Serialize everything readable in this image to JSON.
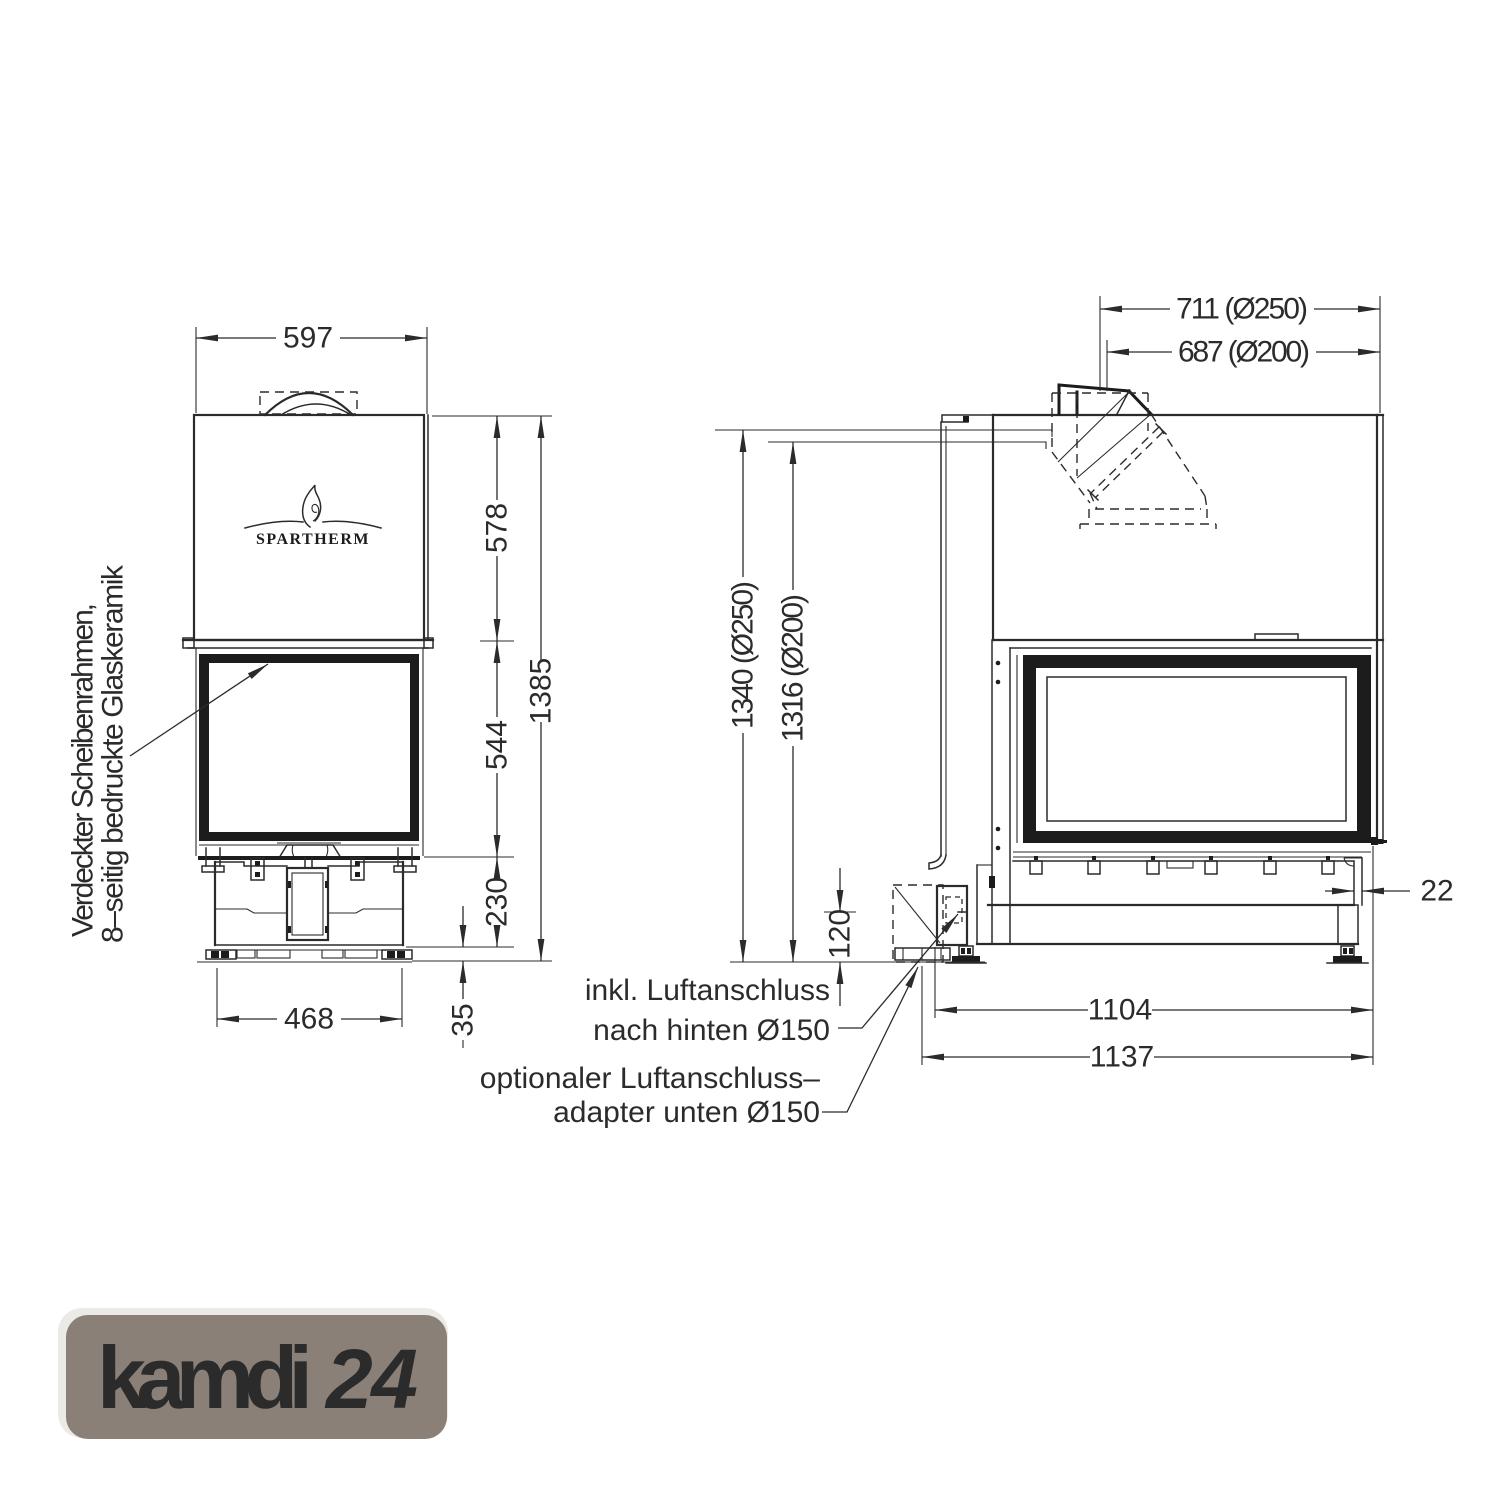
{
  "drawing": {
    "front": {
      "brand": "SPARTHERM",
      "width_top": "597",
      "height_upper": "578",
      "height_glass": "544",
      "height_base": "230",
      "height_total": "1385",
      "width_base": "468",
      "height_feet": "35",
      "label_line1": "Verdeckter Scheibenrahmen,",
      "label_line2": "8–seitig bedruckte Glaskeramik"
    },
    "side": {
      "dim_top_250": "711 (Ø250)",
      "dim_top_200": "687 (Ø200)",
      "dim_h_250": "1340 (Ø250)",
      "dim_h_200": "1316 (Ø200)",
      "dim_air_height": "120",
      "dim_edge": "22",
      "dim_base": "1104",
      "dim_total": "1137"
    },
    "notes": {
      "rear_air_1": "inkl. Luftanschluss",
      "rear_air_2": "nach hinten Ø150",
      "bottom_air_1": "optionaler Luftanschluss–",
      "bottom_air_2": "adapter unten Ø150"
    }
  },
  "logo": {
    "brand": "kamdi",
    "number": "24"
  },
  "colors": {
    "line": "#2b2b2b",
    "logo_bg": "#8b8078",
    "logo_brand": "#a8d6f3",
    "logo_number": "#f3a94e"
  }
}
